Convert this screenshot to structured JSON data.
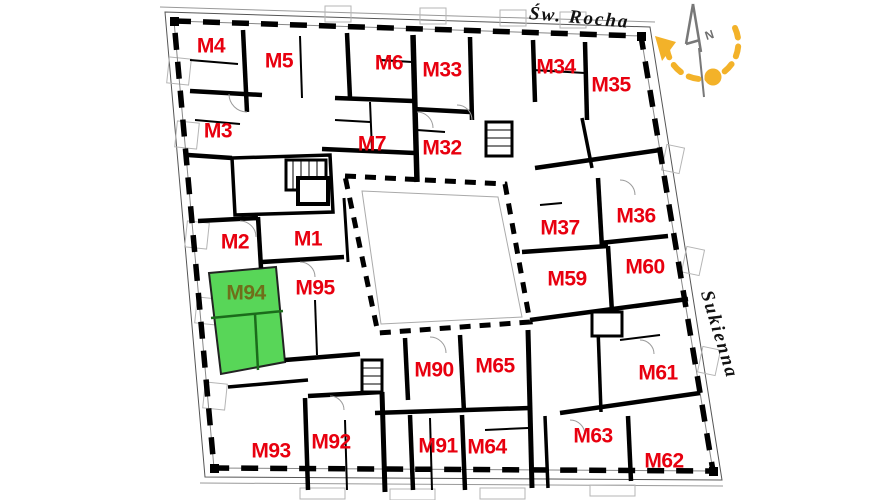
{
  "view": {
    "name": "building-floor-plan"
  },
  "streets": {
    "top": "Św. Rocha",
    "right": "Sukienna"
  },
  "compass": {
    "north_label": "N"
  },
  "highlight": {
    "unit": "M94",
    "fill": "#58d658",
    "label_color": "#6f6f1a"
  },
  "colors": {
    "unit_label": "#e8000f",
    "walls": "#000000",
    "compass_accent": "#f3b229",
    "compass_needle": "#787878",
    "background": "#ffffff"
  },
  "units": [
    {
      "label": "M4",
      "highlighted": false
    },
    {
      "label": "M5",
      "highlighted": false
    },
    {
      "label": "M6",
      "highlighted": false
    },
    {
      "label": "M33",
      "highlighted": false
    },
    {
      "label": "M34",
      "highlighted": false
    },
    {
      "label": "M35",
      "highlighted": false
    },
    {
      "label": "M3",
      "highlighted": false
    },
    {
      "label": "M7",
      "highlighted": false
    },
    {
      "label": "M32",
      "highlighted": false
    },
    {
      "label": "M2",
      "highlighted": false
    },
    {
      "label": "M1",
      "highlighted": false
    },
    {
      "label": "M95",
      "highlighted": false
    },
    {
      "label": "M94",
      "highlighted": true
    },
    {
      "label": "M37",
      "highlighted": false
    },
    {
      "label": "M36",
      "highlighted": false
    },
    {
      "label": "M59",
      "highlighted": false
    },
    {
      "label": "M60",
      "highlighted": false
    },
    {
      "label": "M90",
      "highlighted": false
    },
    {
      "label": "M65",
      "highlighted": false
    },
    {
      "label": "M61",
      "highlighted": false
    },
    {
      "label": "M93",
      "highlighted": false
    },
    {
      "label": "M92",
      "highlighted": false
    },
    {
      "label": "M91",
      "highlighted": false
    },
    {
      "label": "M64",
      "highlighted": false
    },
    {
      "label": "M63",
      "highlighted": false
    },
    {
      "label": "M62",
      "highlighted": false
    }
  ]
}
